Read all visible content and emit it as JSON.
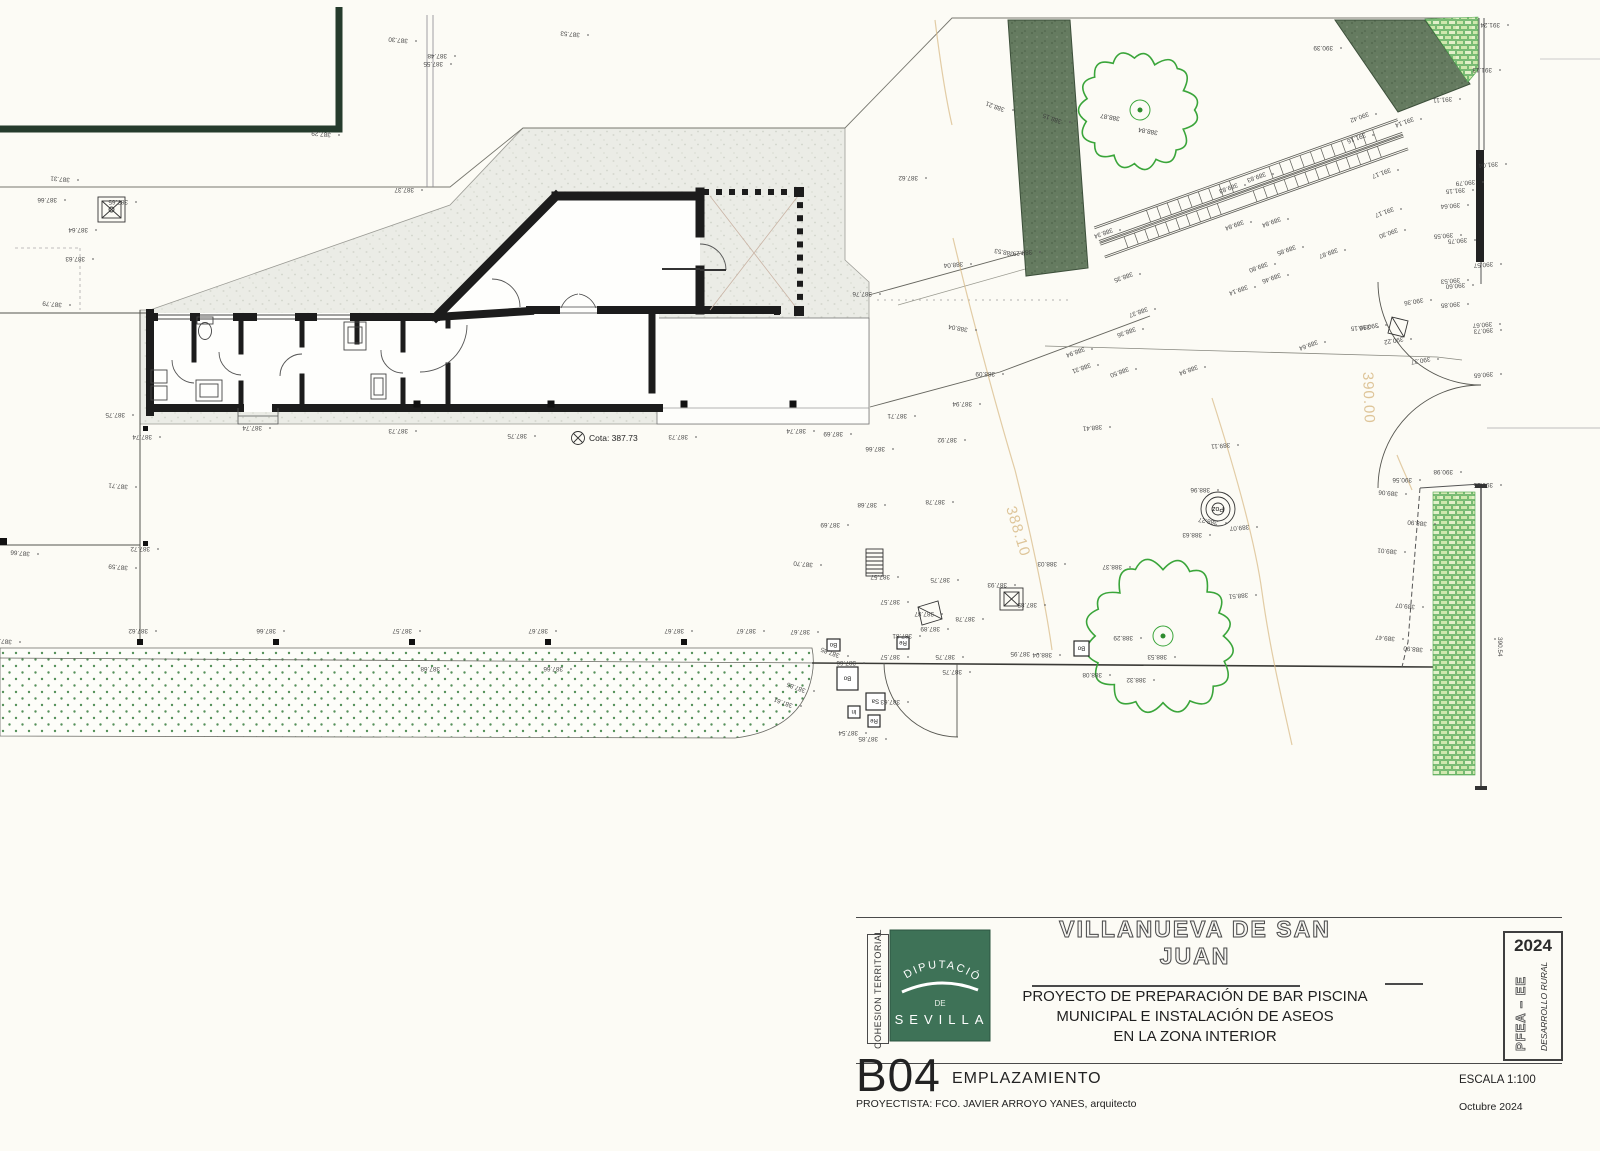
{
  "title_block": {
    "side_label": "COHESION TERRITORIAL",
    "logo": {
      "org_top": "DIPUTACIÓN",
      "org_mid": "DE",
      "org_bottom": "SEVILLA",
      "green": "#3e7257"
    },
    "municipality": "VILLANUEVA DE SAN JUAN",
    "project_line1": "PROYECTO DE PREPARACIÓN DE BAR PISCINA",
    "project_line2": "MUNICIPAL E INSTALACIÓN DE ASEOS",
    "project_line3": "EN LA ZONA INTERIOR",
    "stamp": {
      "year": "2024",
      "program": "PFEA – EE",
      "subprogram": "DESARROLLO RURAL"
    },
    "sheet_code": "B04",
    "sheet_name": "EMPLAZAMIENTO",
    "author_line": "PROYECTISTA: FCO. JAVIER ARROYO YANES, arquitecto",
    "scale": "ESCALA 1:100",
    "date": "Octubre  2024"
  },
  "plan": {
    "cota": {
      "label": "Cota: 387.73",
      "x": 578,
      "y": 438
    },
    "poz": {
      "label": "Poz",
      "cx": 1218,
      "cy": 509
    },
    "contour_labels": [
      {
        "t": "388.10",
        "x": 1006,
        "y": 508,
        "r": 73
      },
      {
        "t": "390.00",
        "x": 1363,
        "y": 372,
        "r": 88
      }
    ],
    "marker_boxes": [
      {
        "t": "Bo",
        "x": 827,
        "y": 639,
        "w": 13,
        "h": 12
      },
      {
        "t": "Re",
        "x": 897,
        "y": 637,
        "w": 12,
        "h": 12
      },
      {
        "t": "Bo",
        "x": 837,
        "y": 667,
        "w": 21,
        "h": 23
      },
      {
        "t": "Sa",
        "x": 866,
        "y": 693,
        "w": 19,
        "h": 17
      },
      {
        "t": "In",
        "x": 848,
        "y": 706,
        "w": 12,
        "h": 12
      },
      {
        "t": "Re",
        "x": 868,
        "y": 715,
        "w": 12,
        "h": 12
      },
      {
        "t": "Bo",
        "x": 1074,
        "y": 641,
        "w": 15,
        "h": 15
      }
    ],
    "tree_labels": [
      {
        "t": "388.87",
        "x": 1120,
        "y": 117,
        "r": 190
      },
      {
        "t": "388.84",
        "x": 1158,
        "y": 131,
        "r": 190
      }
    ],
    "elevation_labels": [
      [
        "387.30",
        408,
        39,
        185
      ],
      [
        "387.48",
        447,
        54,
        180
      ],
      [
        "387.55",
        443,
        62,
        180
      ],
      [
        "387.53",
        580,
        33,
        185
      ],
      [
        "387.29",
        331,
        133,
        185
      ],
      [
        "387.31",
        70,
        178,
        185
      ],
      [
        "387.66",
        57,
        198,
        180
      ],
      [
        "387.65",
        128,
        200,
        180
      ],
      [
        "387.64",
        88,
        228,
        180
      ],
      [
        "387.63",
        85,
        257,
        180
      ],
      [
        "387.79",
        62,
        303,
        185
      ],
      [
        "387.37",
        414,
        188,
        180
      ],
      [
        "387.62",
        918,
        176,
        180
      ],
      [
        "387.75",
        125,
        413,
        180
      ],
      [
        "387.74",
        152,
        435,
        180
      ],
      [
        "387.71",
        128,
        485,
        185
      ],
      [
        "387.72",
        150,
        547,
        180
      ],
      [
        "387.66",
        30,
        552,
        185
      ],
      [
        "387.59",
        128,
        566,
        185
      ],
      [
        "387.74",
        262,
        426,
        180
      ],
      [
        "387.73",
        408,
        429,
        180
      ],
      [
        "387.75",
        527,
        434,
        180
      ],
      [
        "387.73",
        688,
        435,
        180
      ],
      [
        "387.74",
        806,
        429,
        180
      ],
      [
        "387.69",
        843,
        432,
        180
      ],
      [
        "387.71",
        907,
        414,
        180
      ],
      [
        "387.66",
        885,
        447,
        180
      ],
      [
        "387.92",
        957,
        438,
        180
      ],
      [
        "387.94",
        972,
        402,
        180
      ],
      [
        "388.09",
        995,
        372,
        180
      ],
      [
        "388.04",
        963,
        262,
        175
      ],
      [
        "388.29",
        1032,
        250,
        175
      ],
      [
        "387.76",
        872,
        292,
        180
      ],
      [
        "387.68",
        877,
        503,
        180
      ],
      [
        "387.78",
        945,
        500,
        180
      ],
      [
        "387.69",
        840,
        523,
        180
      ],
      [
        "387.70",
        813,
        563,
        185
      ],
      [
        "387.57",
        890,
        575,
        180
      ],
      [
        "387.75",
        950,
        578,
        180
      ],
      [
        "387.93",
        1007,
        583,
        180
      ],
      [
        "387.85",
        1037,
        603,
        180
      ],
      [
        "387.78",
        975,
        617,
        180
      ],
      [
        "387.89",
        940,
        627,
        180
      ],
      [
        "387.57",
        900,
        600,
        180
      ],
      [
        "387.67",
        810,
        630,
        180
      ],
      [
        "387.85",
        840,
        654,
        200
      ],
      [
        "387.57",
        900,
        655,
        180
      ],
      [
        "387.75",
        955,
        655,
        180
      ],
      [
        "387.95",
        1030,
        652,
        180
      ],
      [
        "388.04",
        1052,
        653,
        180
      ],
      [
        "388.08",
        1102,
        673,
        180
      ],
      [
        "387.51",
        12,
        640,
        185
      ],
      [
        "387.62",
        148,
        629,
        180
      ],
      [
        "387.66",
        276,
        629,
        180
      ],
      [
        "387.57",
        412,
        629,
        180
      ],
      [
        "387.67",
        548,
        629,
        180
      ],
      [
        "387.67",
        684,
        629,
        180
      ],
      [
        "387.67",
        756,
        629,
        180
      ],
      [
        "387.68",
        440,
        667,
        180
      ],
      [
        "387.66",
        563,
        667,
        180
      ],
      [
        "387.85",
        806,
        689,
        200
      ],
      [
        "387.61",
        793,
        704,
        200
      ],
      [
        "387.63",
        900,
        700,
        180
      ],
      [
        "387.54",
        858,
        731,
        180
      ],
      [
        "387.85",
        878,
        737,
        180
      ],
      [
        "387.81",
        912,
        634,
        180
      ],
      [
        "387.87",
        934,
        612,
        180
      ],
      [
        "387.66",
        856,
        661,
        180
      ],
      [
        "387.75",
        962,
        670,
        180
      ],
      [
        "388.29",
        1133,
        636,
        180
      ],
      [
        "388.53",
        1167,
        655,
        180
      ],
      [
        "388.32",
        1146,
        678,
        180
      ],
      [
        "388.51",
        1248,
        593,
        175
      ],
      [
        "388.96",
        1210,
        488,
        180
      ],
      [
        "389.07",
        1249,
        525,
        175
      ],
      [
        "388.63",
        1202,
        533,
        180
      ],
      [
        "388.27",
        1218,
        521,
        190
      ],
      [
        "389.11",
        1230,
        443,
        175
      ],
      [
        "388.41",
        1102,
        425,
        175
      ],
      [
        "388.37",
        1122,
        565,
        180
      ],
      [
        "388.03",
        1057,
        562,
        180
      ],
      [
        "388.34",
        1112,
        228,
        160
      ],
      [
        "388.35",
        1132,
        272,
        160
      ],
      [
        "388.37",
        1147,
        307,
        160
      ],
      [
        "388.36",
        1135,
        327,
        160
      ],
      [
        "388.94",
        1084,
        347,
        160
      ],
      [
        "388.31",
        1090,
        363,
        160
      ],
      [
        "388.50",
        1128,
        367,
        160
      ],
      [
        "388.94",
        1197,
        365,
        160
      ],
      [
        "389.64",
        1317,
        340,
        160
      ],
      [
        "389.83",
        1265,
        172,
        160
      ],
      [
        "389.83",
        1237,
        183,
        160
      ],
      [
        "389.84",
        1243,
        220,
        160
      ],
      [
        "389.84",
        1280,
        217,
        160
      ],
      [
        "389.85",
        1295,
        245,
        160
      ],
      [
        "389.80",
        1267,
        262,
        160
      ],
      [
        "389.46",
        1280,
        273,
        160
      ],
      [
        "389.14",
        1247,
        285,
        160
      ],
      [
        "389.87",
        1337,
        248,
        160
      ],
      [
        "390.30",
        1397,
        228,
        160
      ],
      [
        "391.17",
        1393,
        207,
        160
      ],
      [
        "391.17",
        1390,
        168,
        160
      ],
      [
        "391.16",
        1365,
        133,
        160
      ],
      [
        "391.14",
        1413,
        117,
        160
      ],
      [
        "390.42",
        1368,
        112,
        160
      ],
      [
        "390.16",
        1378,
        323,
        170
      ],
      [
        "390.22",
        1403,
        337,
        170
      ],
      [
        "390.36",
        1423,
        298,
        170
      ],
      [
        "390.37",
        1430,
        357,
        170
      ],
      [
        "388.21",
        1005,
        108,
        200
      ],
      [
        "388.15",
        1062,
        120,
        200
      ],
      [
        "388.53",
        1014,
        252,
        190
      ],
      [
        "388.04",
        968,
        328,
        190
      ],
      [
        "390.39",
        1333,
        46,
        180
      ],
      [
        "391.11",
        1452,
        97,
        175
      ],
      [
        "391.13",
        1492,
        68,
        180
      ],
      [
        "391.24",
        1500,
        23,
        180
      ],
      [
        "391.04",
        1498,
        162,
        175
      ],
      [
        "390.79",
        1475,
        180,
        175
      ],
      [
        "391.15",
        1465,
        188,
        175
      ],
      [
        "390.64",
        1460,
        203,
        175
      ],
      [
        "390.55",
        1453,
        233,
        175
      ],
      [
        "390.75",
        1467,
        238,
        175
      ],
      [
        "390.57",
        1493,
        262,
        175
      ],
      [
        "390.53",
        1460,
        278,
        175
      ],
      [
        "390.60",
        1465,
        283,
        175
      ],
      [
        "390.85",
        1460,
        302,
        175
      ],
      [
        "390.67",
        1492,
        322,
        175
      ],
      [
        "390.73",
        1493,
        328,
        175
      ],
      [
        "390.15",
        1370,
        325,
        175
      ],
      [
        "390.65",
        1493,
        372,
        175
      ],
      [
        "390.98",
        1453,
        470,
        180
      ],
      [
        "390.56",
        1412,
        478,
        180
      ],
      [
        "390.55",
        1493,
        483,
        180
      ],
      [
        "389.06",
        1398,
        492,
        185
      ],
      [
        "388.90",
        1427,
        522,
        185
      ],
      [
        "389.01",
        1397,
        550,
        185
      ],
      [
        "390.54",
        1498,
        637,
        90
      ],
      [
        "389.07",
        1415,
        605,
        185
      ],
      [
        "389.47",
        1395,
        637,
        185
      ],
      [
        "388.90",
        1423,
        648,
        185
      ]
    ],
    "colors": {
      "wall": "#1c1c1c",
      "pool_wall": "#253b2c",
      "paving": "#ebece6",
      "dark_band": "#657b60",
      "tree_green": "#3aa53a",
      "grass_dot": "#55915a",
      "brick_green": "#4aa34a",
      "contour_tan": "#d9bc8a"
    }
  }
}
